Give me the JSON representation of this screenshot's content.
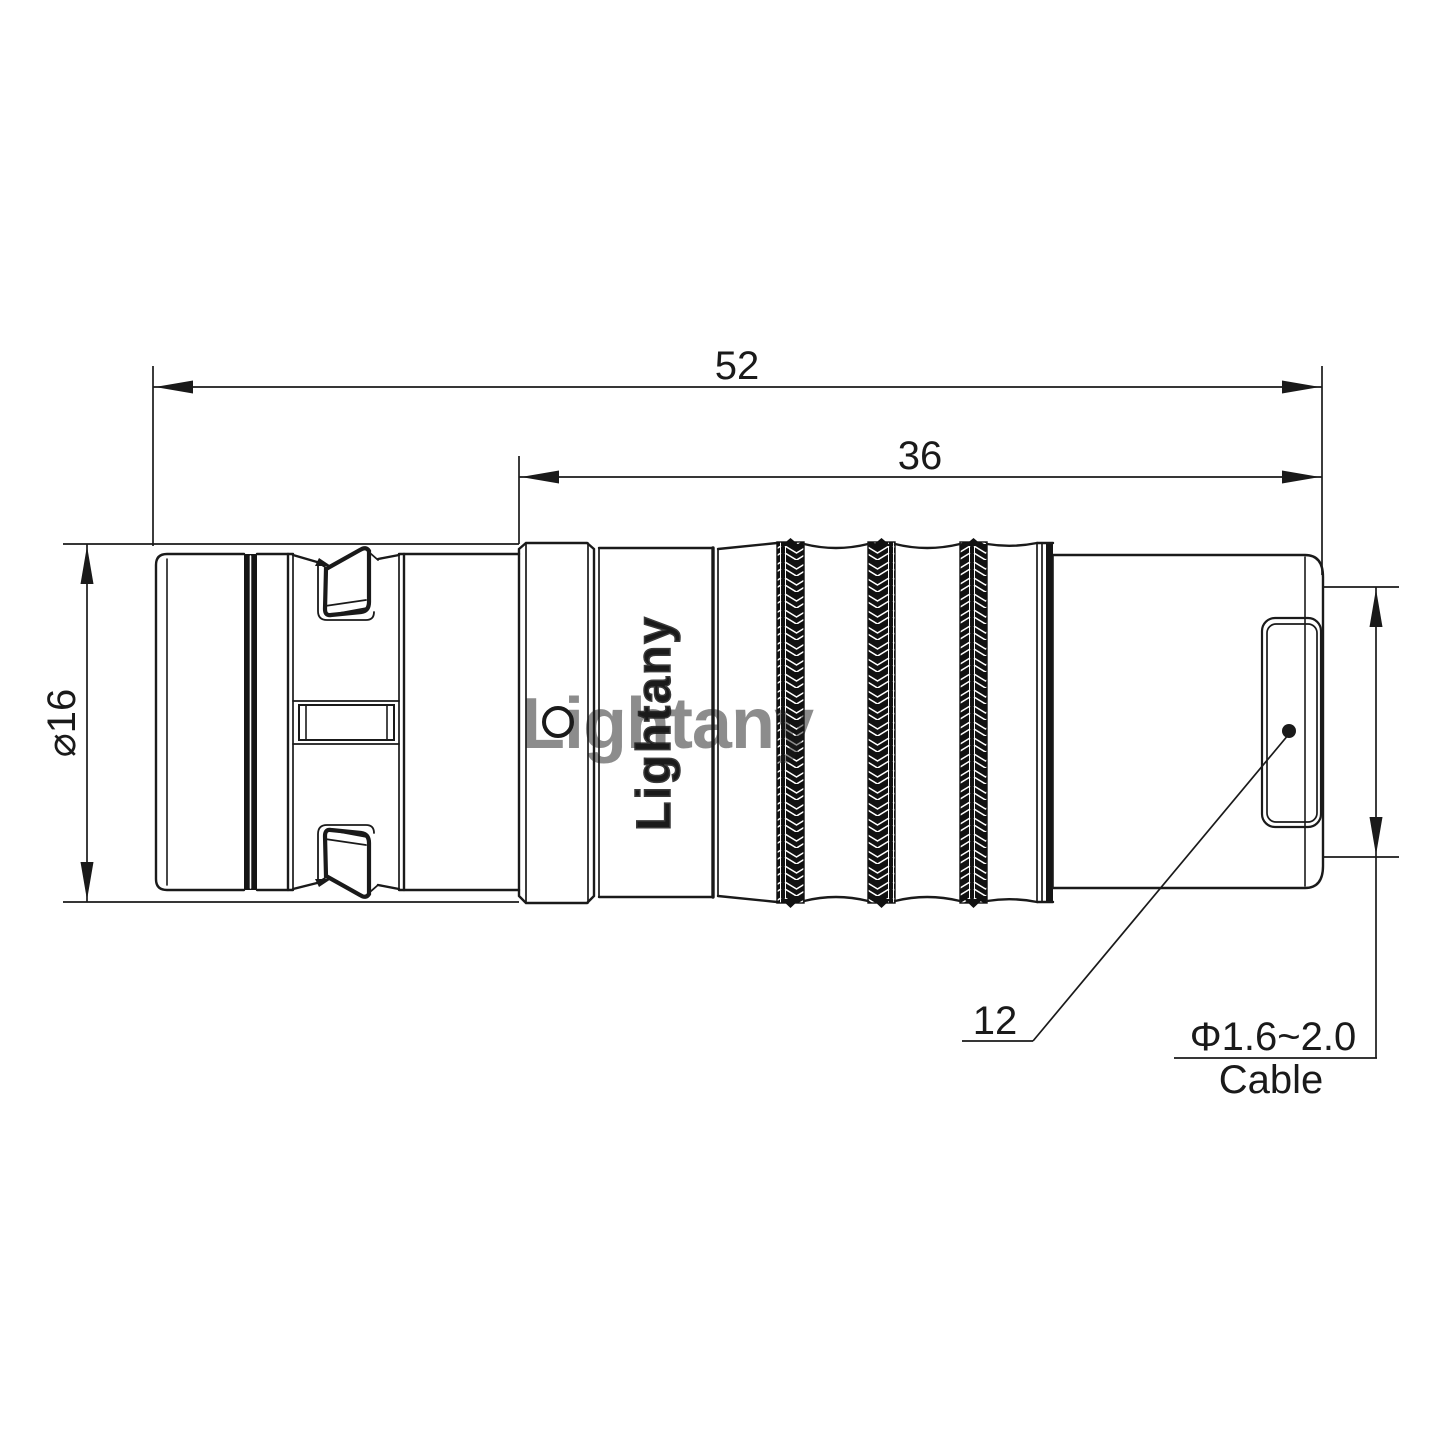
{
  "drawing_type": "connector-technical-drawing",
  "brand": {
    "vertical_label": "Lightany",
    "watermark": "Lightany"
  },
  "dimensions": {
    "overall_length": "52",
    "rear_length": "36",
    "body_diameter": "⌀16",
    "nose_diameter": "12",
    "cable_range": "Φ1.6~2.0",
    "cable_label": "Cable"
  },
  "colors": {
    "line": "#1a1a1a",
    "thin_line": "#1a1a1a",
    "knurl_fill": "#111111",
    "watermark": "#e06666",
    "background": "#ffffff"
  }
}
